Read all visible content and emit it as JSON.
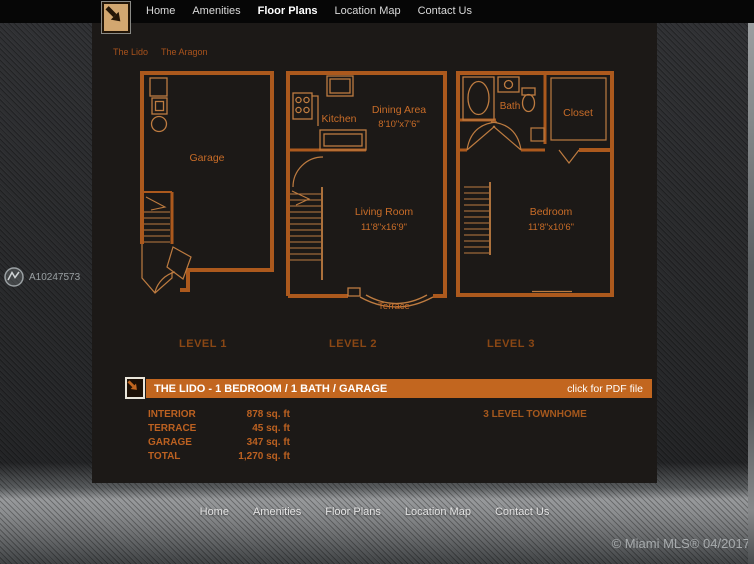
{
  "header": {
    "nav": [
      {
        "label": "Home"
      },
      {
        "label": "Amenities"
      },
      {
        "label": "Floor Plans",
        "active": true
      },
      {
        "label": "Location Map"
      },
      {
        "label": "Contact Us"
      }
    ]
  },
  "subnav": [
    {
      "label": "The Lido"
    },
    {
      "label": "The Aragon"
    }
  ],
  "plans": {
    "level1": {
      "name": "LEVEL 1",
      "garage": "Garage"
    },
    "level2": {
      "name": "LEVEL 2",
      "kitchen": "Kitchen",
      "dining": "Dining Area",
      "dining_dims": "8'10\"x7'6\"",
      "living": "Living Room",
      "living_dims": "11'8\"x16'9\"",
      "terrace": "Terrace"
    },
    "level3": {
      "name": "LEVEL 3",
      "bath": "Bath",
      "closet": "Closet",
      "bedroom": "Bedroom",
      "bedroom_dims": "11'8\"x10'6\""
    }
  },
  "banner": {
    "title": "THE LIDO - 1 BEDROOM / 1 BATH / GARAGE",
    "action": "click for PDF file"
  },
  "stats": {
    "rows": [
      {
        "label": "INTERIOR",
        "value": "878 sq. ft"
      },
      {
        "label": "TERRACE",
        "value": "45 sq. ft"
      },
      {
        "label": "GARAGE",
        "value": "347 sq. ft"
      },
      {
        "label": "TOTAL",
        "value": "1,270 sq. ft"
      }
    ],
    "type_label": "3 LEVEL TOWNHOME"
  },
  "footer": {
    "nav": [
      {
        "label": "Home"
      },
      {
        "label": "Amenities"
      },
      {
        "label": "Floor Plans"
      },
      {
        "label": "Location Map"
      },
      {
        "label": "Contact Us"
      }
    ]
  },
  "watermark": {
    "id": "A10247573"
  },
  "copyright": {
    "text": "© Miami MLS® 04/2017"
  },
  "colors": {
    "topbar_bg": "#060606",
    "panel_bg": "#1c1917",
    "banner_bg": "#c2661f",
    "level_label": "#8a4714",
    "plan_wall": "#ac591d",
    "plan_detail": "#bd7b40",
    "plan_text": "#c86c28",
    "watermark_text": "#9aa0a3"
  }
}
